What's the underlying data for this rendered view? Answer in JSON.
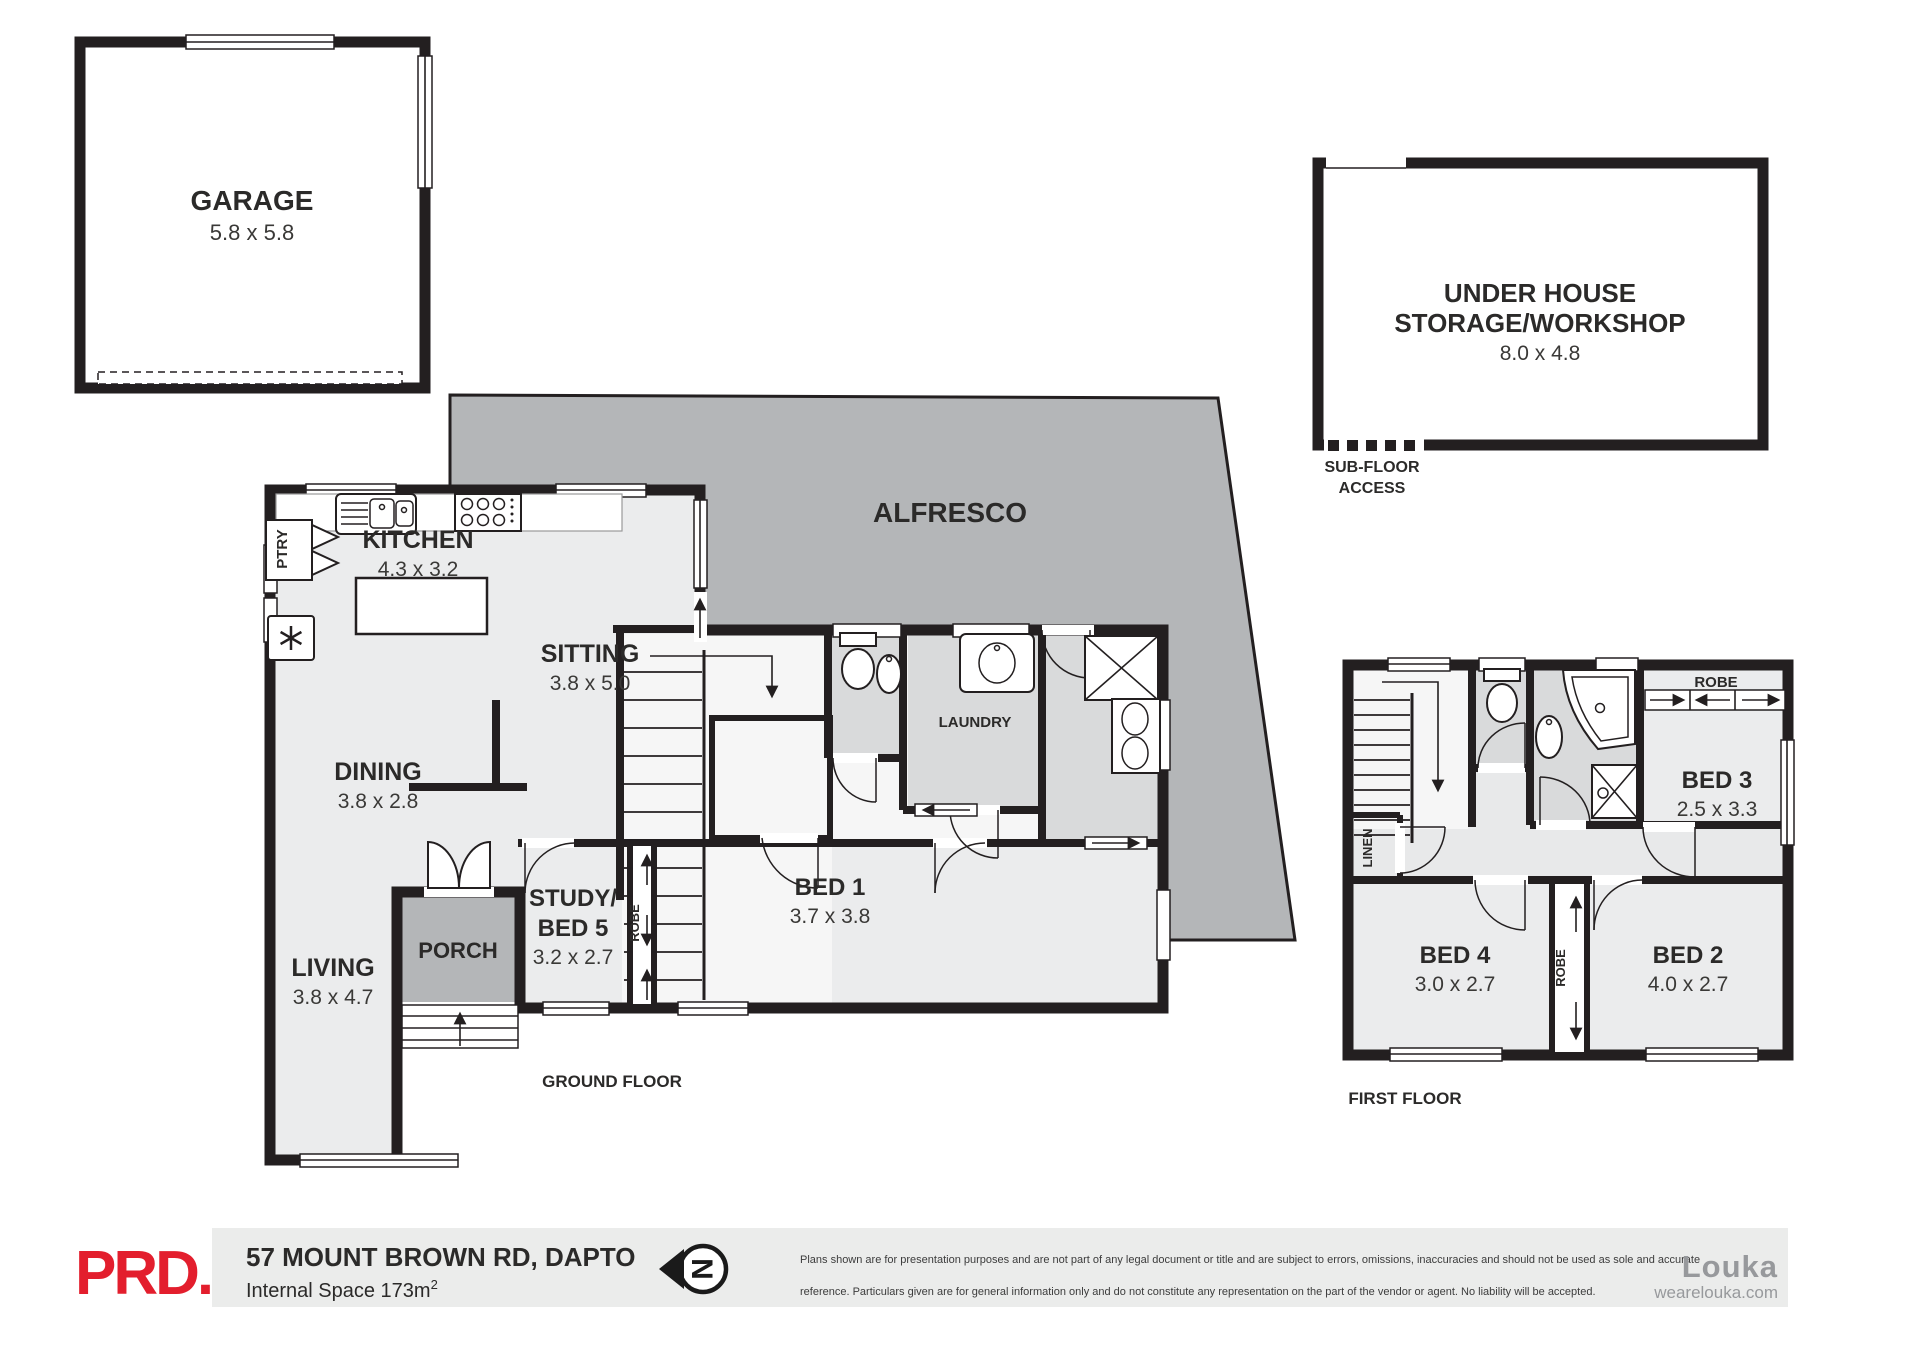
{
  "meta": {
    "document_type": "real-estate floor plan",
    "colors": {
      "wall": "#231f20",
      "room_fill": "#ebeced",
      "wet_area_fill": "#d9dadb",
      "outdoor_fill": "#b4b6b8",
      "footer_band": "#ebeceb",
      "agency_red": "#e31e2d",
      "brand_gray": "#97999c"
    }
  },
  "plans": {
    "garage": {
      "name": "GARAGE",
      "dims": "5.8 x 5.8"
    },
    "under_house": {
      "line1": "UNDER HOUSE",
      "line2": "STORAGE/WORKSHOP",
      "dims": "8.0 x 4.8"
    },
    "under_house_access": {
      "line1": "SUB-FLOOR",
      "line2": "ACCESS"
    },
    "alfresco": {
      "name": "ALFRESCO"
    },
    "ground": {
      "title": "GROUND FLOOR",
      "kitchen": {
        "name": "KITCHEN",
        "dims": "4.3 x 3.2"
      },
      "pantry": {
        "name": "PTRY"
      },
      "sitting": {
        "name": "SITTING",
        "dims": "3.8 x 5.0"
      },
      "dining": {
        "name": "DINING",
        "dims": "3.8 x 2.8"
      },
      "living": {
        "name": "LIVING",
        "dims": "3.8 x 4.7"
      },
      "porch": {
        "name": "PORCH"
      },
      "study": {
        "line1": "STUDY/",
        "line2": "BED 5",
        "dims": "3.2 x 2.7"
      },
      "robe": {
        "name": "ROBE"
      },
      "bed1": {
        "name": "BED 1",
        "dims": "3.7 x 3.8"
      },
      "laundry": {
        "name": "LAUNDRY"
      }
    },
    "first": {
      "title": "FIRST FLOOR",
      "bed2": {
        "name": "BED 2",
        "dims": "4.0 x 2.7"
      },
      "bed3": {
        "name": "BED 3",
        "dims": "2.5 x 3.3"
      },
      "bed4": {
        "name": "BED 4",
        "dims": "3.0 x 2.7"
      },
      "robe_top": {
        "name": "ROBE"
      },
      "robe_mid": {
        "name": "ROBE"
      },
      "linen": {
        "name": "LINEN"
      }
    }
  },
  "footer": {
    "agency_logo": "PRD.",
    "address": "57 MOUNT BROWN RD, DAPTO",
    "internal_space": "Internal Space 173m",
    "internal_space_sup": "2",
    "north_letter": "N",
    "disclaimer1": "Plans shown are for presentation purposes and are not part of any legal document or title and are subject to errors, omissions, inaccuracies and should not be used as sole and accurate",
    "disclaimer2": "reference. Particulars given are for general information only and do not constitute any representation on the part of the vendor or agent. No liability will be accepted.",
    "brand_name": "Louka",
    "brand_site": "wearelouka.com"
  }
}
